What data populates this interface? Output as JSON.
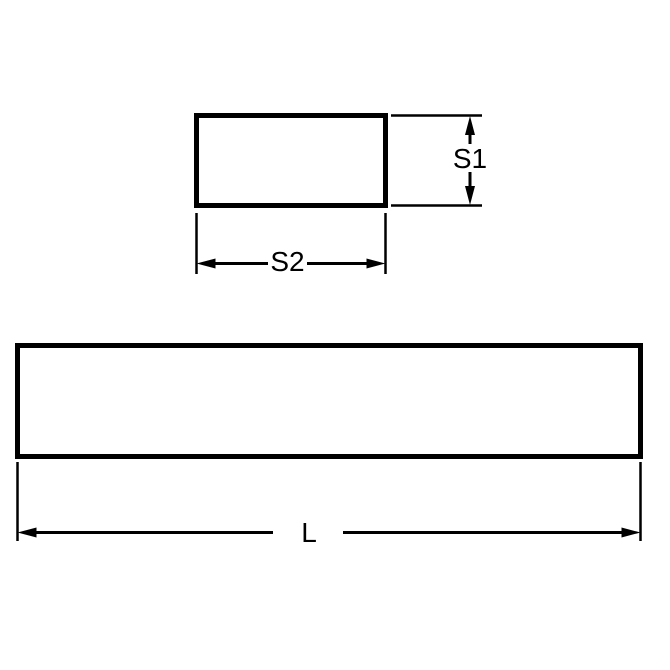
{
  "diagram": {
    "background_color": "#ffffff",
    "line_color": "#000000",
    "shape_fill": "#ffffff",
    "labels": {
      "s1": "S1",
      "s2": "S2",
      "l": "L"
    }
  }
}
